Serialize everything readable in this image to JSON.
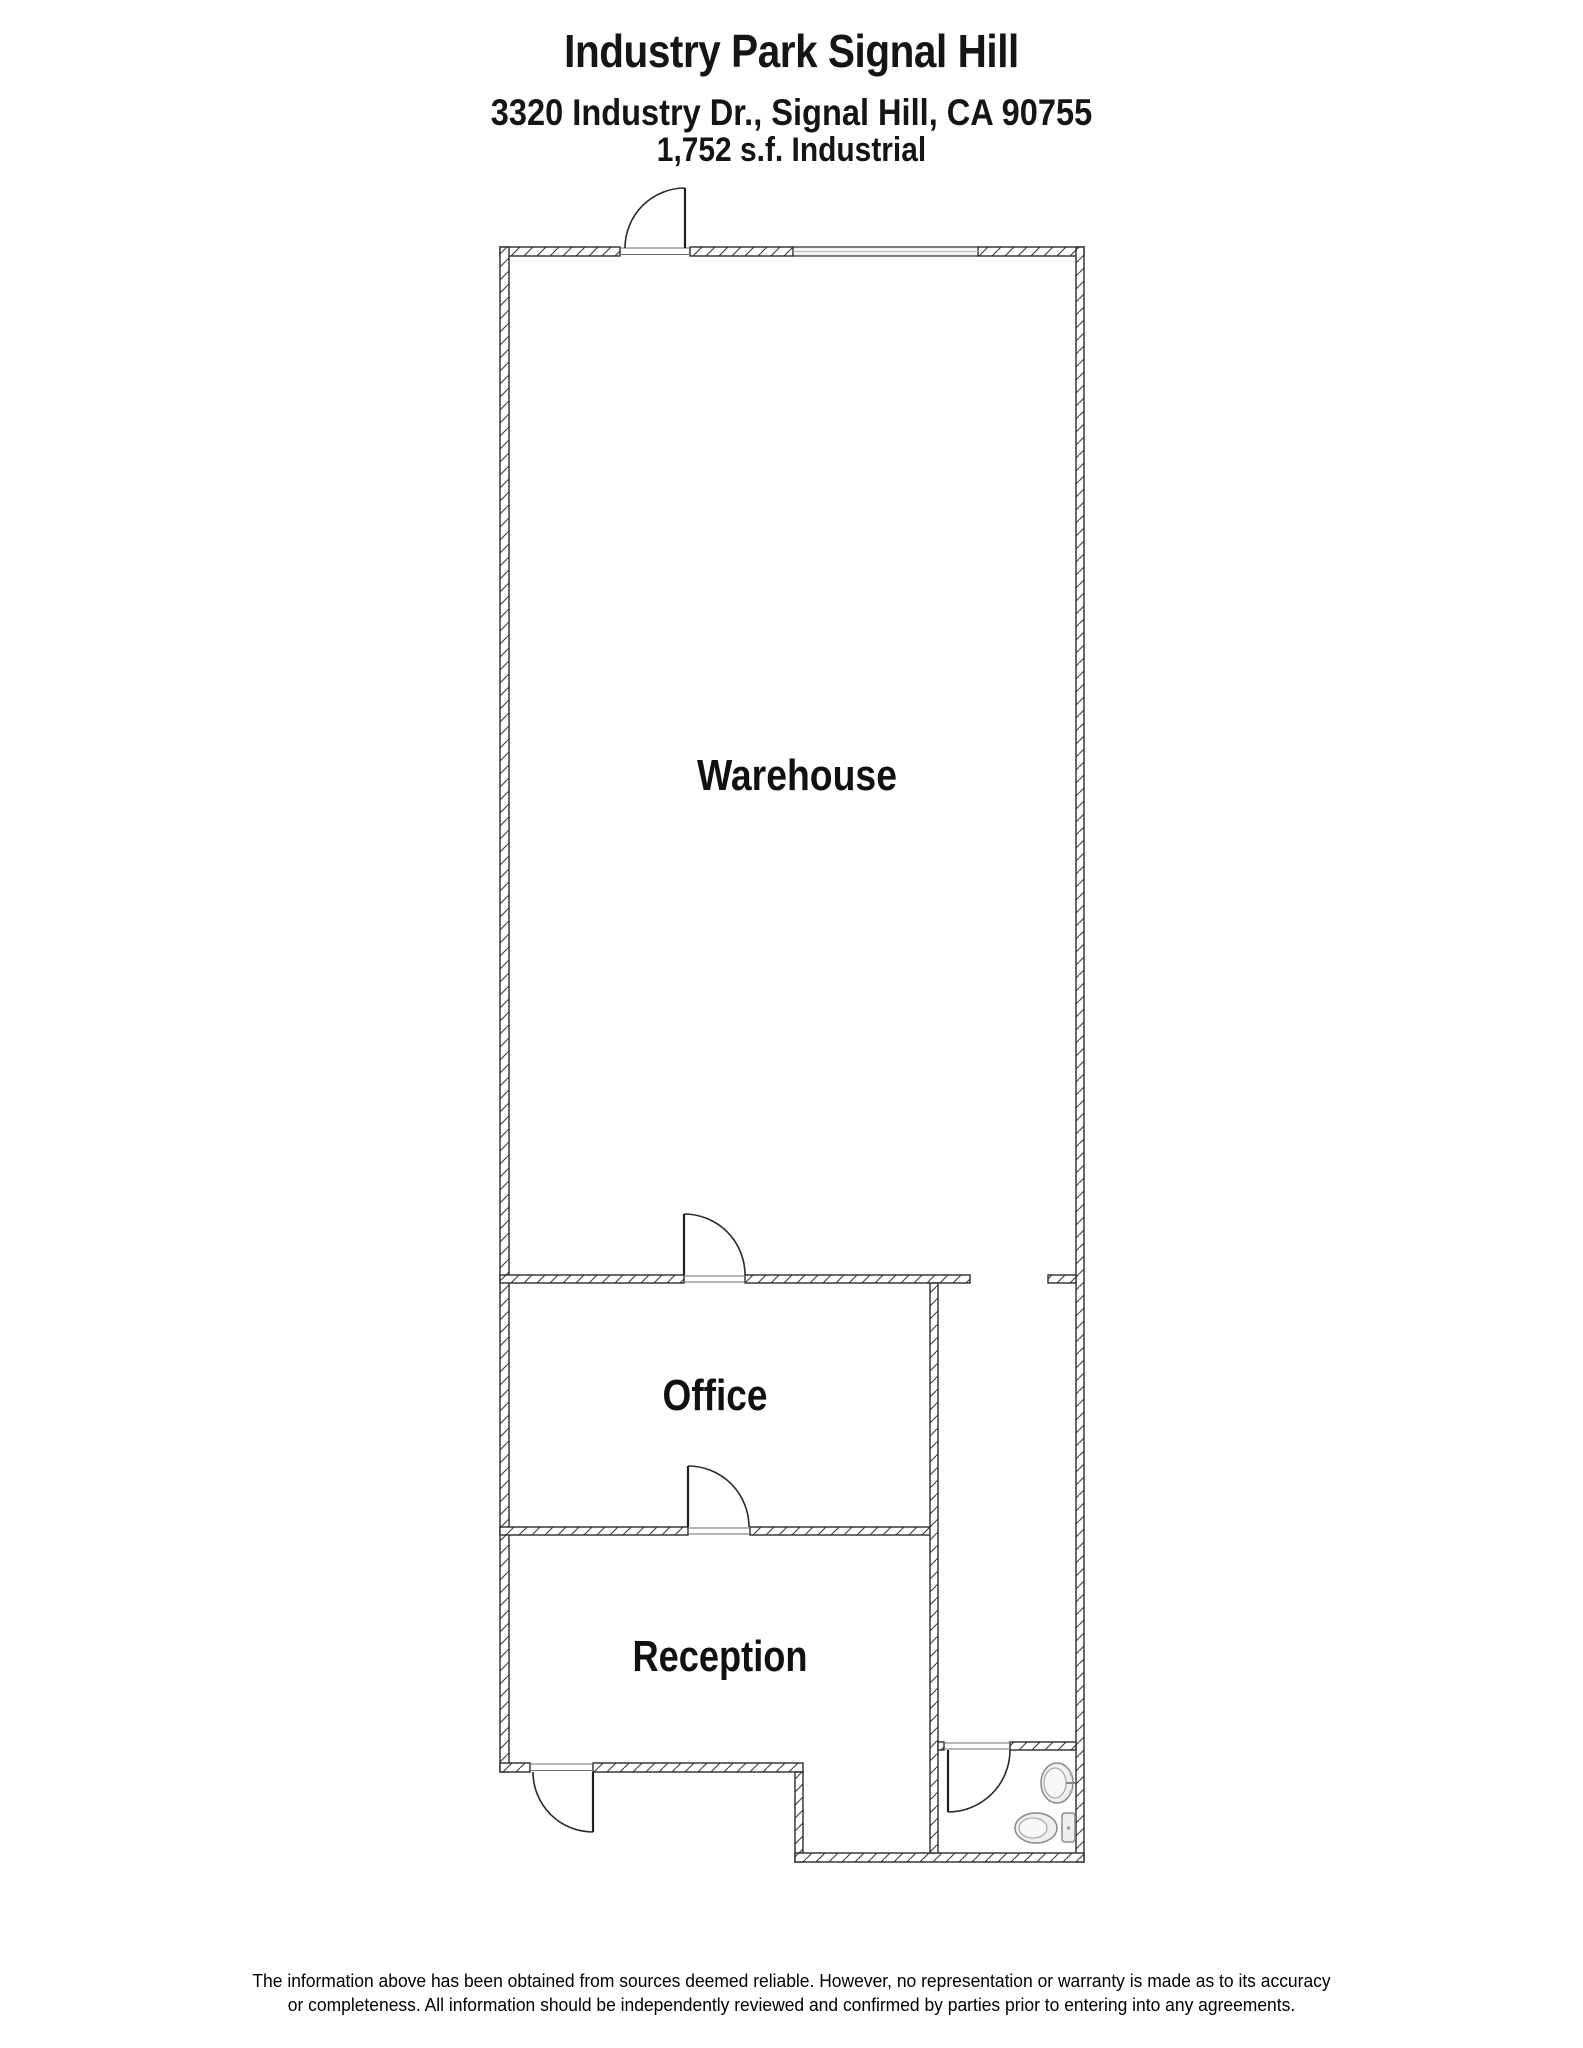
{
  "header": {
    "title": "Industry Park Signal Hill",
    "address": "3320 Industry Dr., Signal Hill, CA 90755",
    "size": "1,752 s.f. Industrial"
  },
  "floorplan": {
    "rooms": [
      {
        "label": "Warehouse"
      },
      {
        "label": "Office"
      },
      {
        "label": "Reception"
      }
    ],
    "fixtures": [
      {
        "icon": "sink-icon"
      },
      {
        "icon": "toilet-icon"
      }
    ]
  },
  "footer": {
    "line1": "The information above has been obtained from sources deemed reliable. However, no representation or warranty is made as to its accuracy",
    "line2": "or completeness. All information should be independently reviewed and confirmed by parties prior to entering into any agreements."
  },
  "colors": {
    "background": "#ffffff",
    "wall_outline": "#2b2b2b",
    "hatch_line": "#3a3a3a",
    "door_line": "#1f1f1f",
    "fixture_fill": "#efefef",
    "fixture_outline": "#8a8a8a",
    "text": "#111111"
  }
}
